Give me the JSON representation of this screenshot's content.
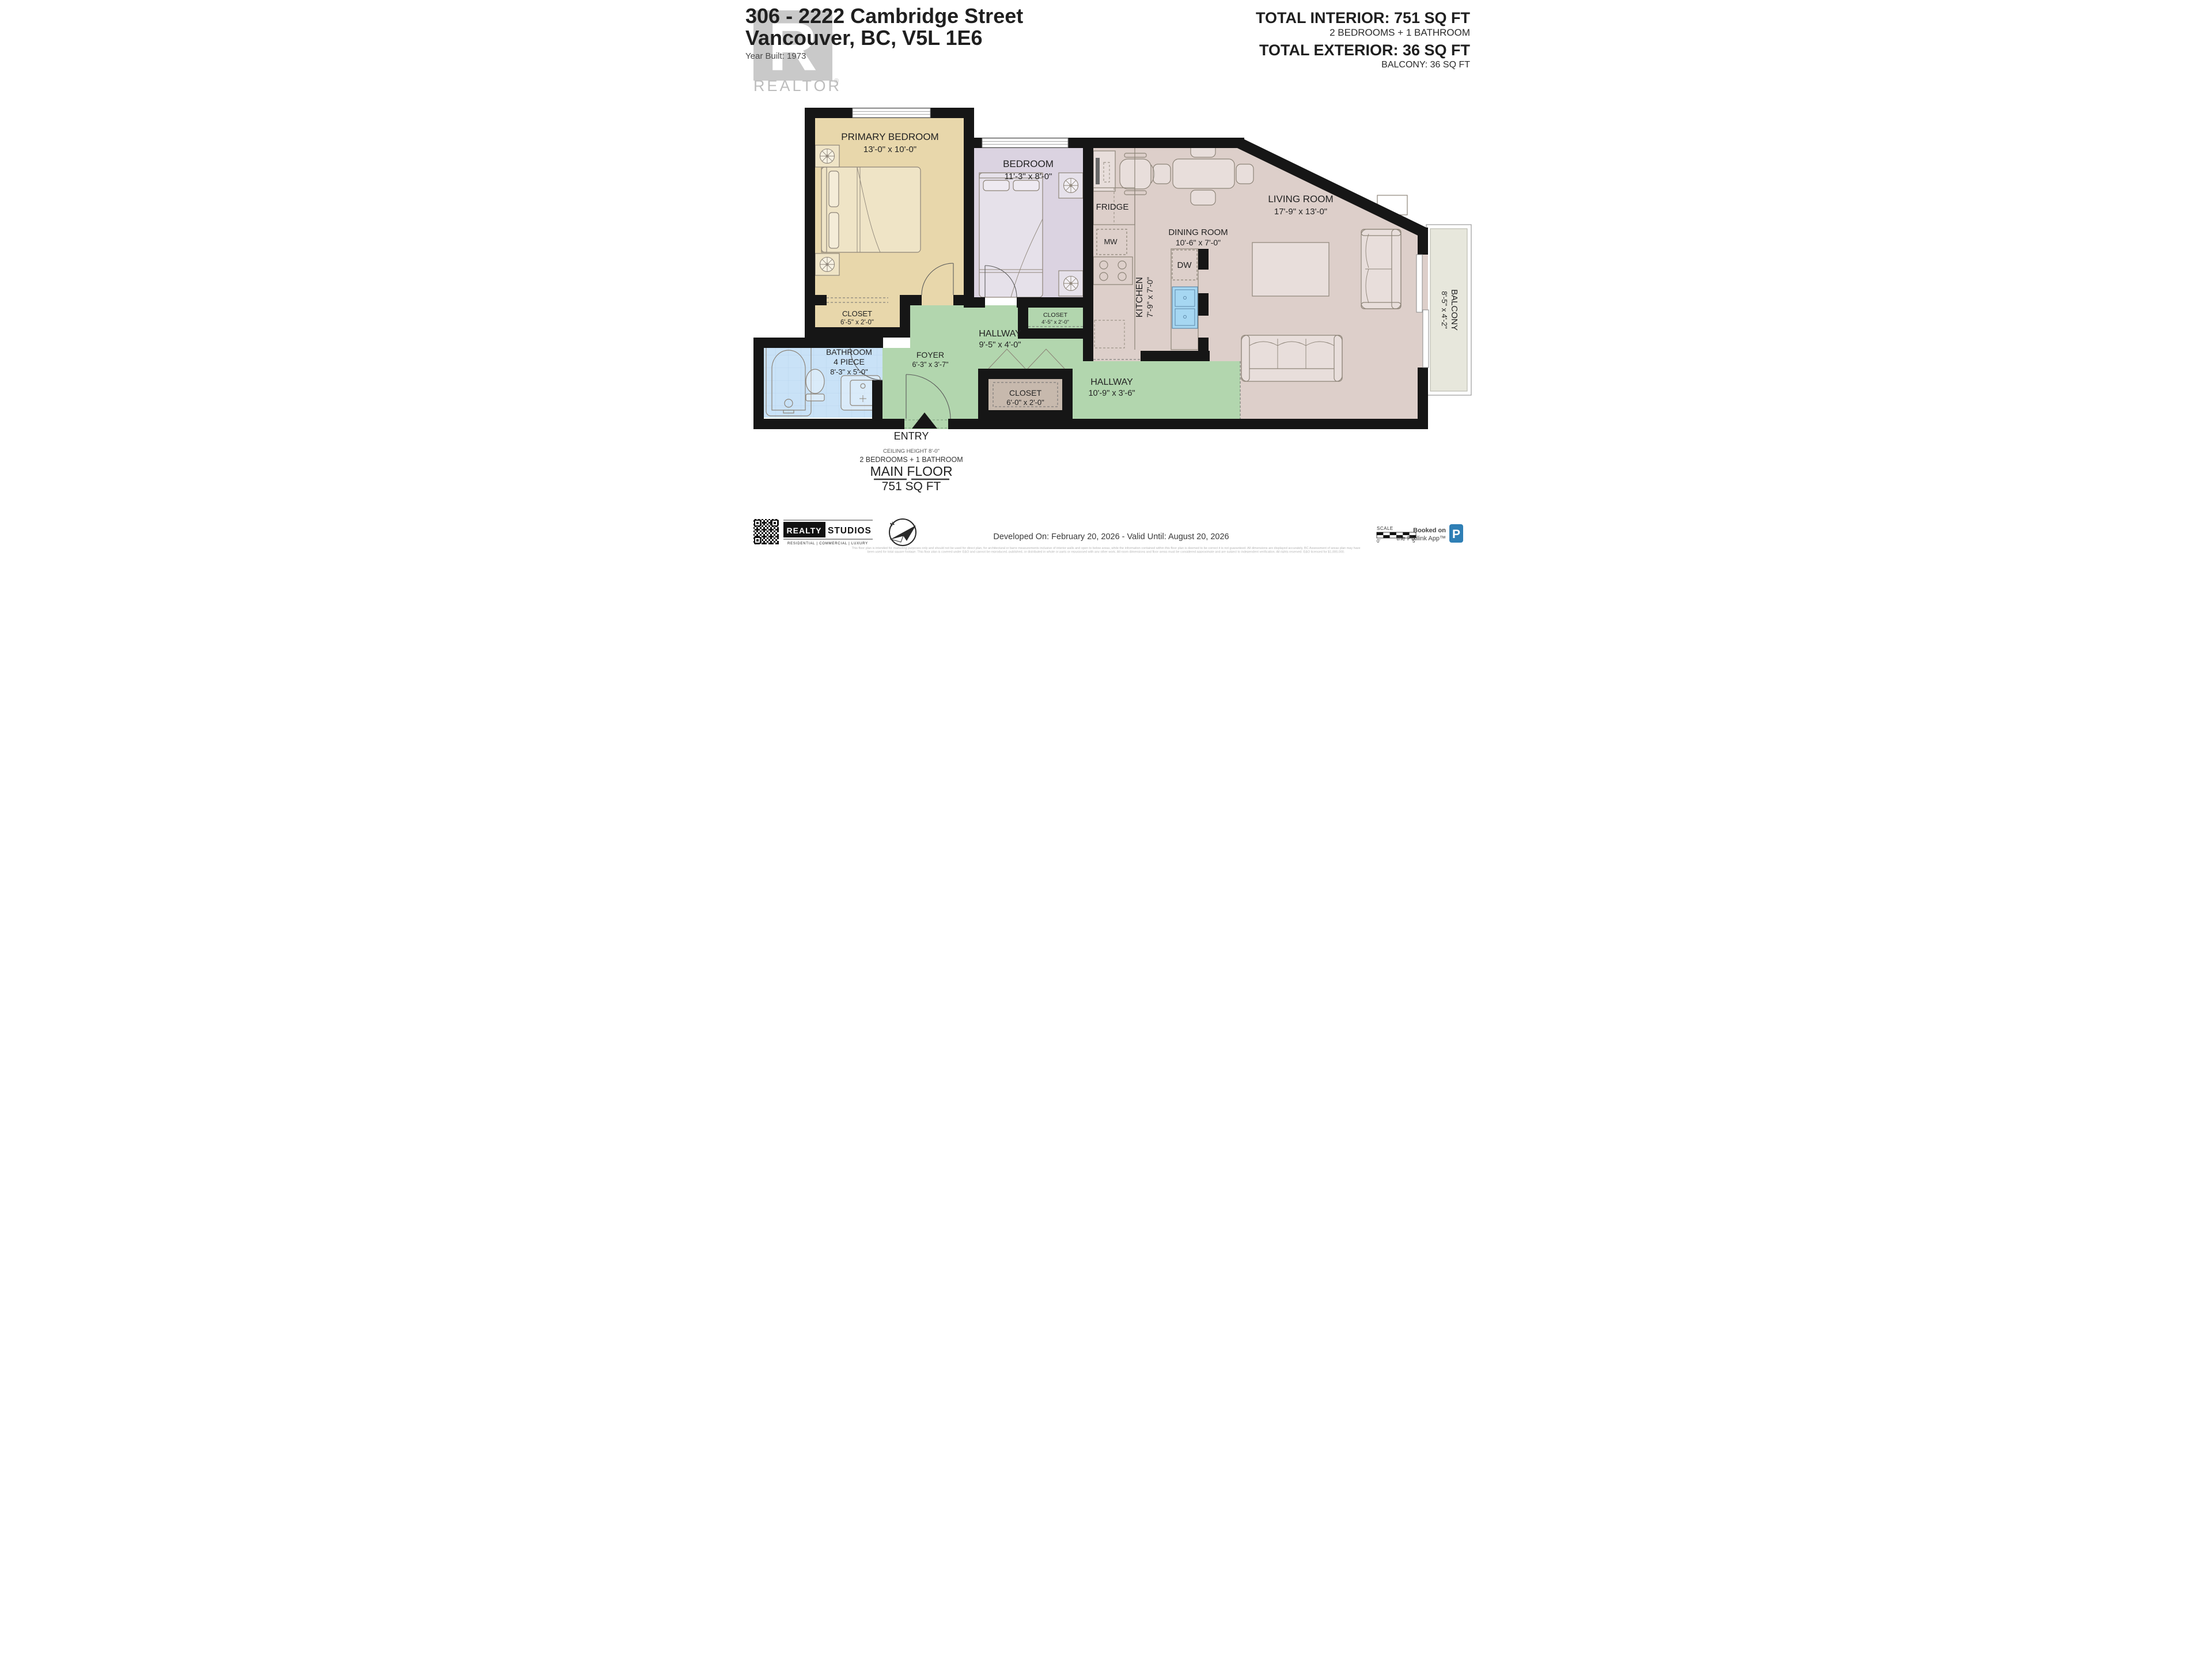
{
  "header": {
    "line1": "306 - 2222 Cambridge Street",
    "line2": "Vancouver, BC, V5L 1E6",
    "year_built": "Year Built: 1973"
  },
  "watermark": {
    "letter": "R",
    "brand": "REALTOR",
    "reg": "®"
  },
  "totals": {
    "interior_label": "TOTAL INTERIOR: 751 SQ FT",
    "interior_sub": "2 BEDROOMS + 1 BATHROOM",
    "exterior_label": "TOTAL EXTERIOR: 36 SQ FT",
    "exterior_sub": "BALCONY: 36 SQ FT"
  },
  "rooms": {
    "primary": {
      "name": "PRIMARY BEDROOM",
      "dims": "13'-0\" x 10'-0\""
    },
    "bedroom": {
      "name": "BEDROOM",
      "dims": "11'-3\" x 8'-0\""
    },
    "closet_primary": {
      "name": "CLOSET",
      "dims": "6'-5\" x 2'-0\""
    },
    "closet_bedroom": {
      "name": "CLOSET",
      "dims": "4'-5\" x 2'-0\""
    },
    "closet_hall": {
      "name": "CLOSET",
      "dims": "6'-0\" x 2'-0\""
    },
    "bathroom": {
      "name": "BATHROOM",
      "type": "4 PIECE",
      "dims": "8'-3\" x 5'-0\""
    },
    "foyer": {
      "name": "FOYER",
      "dims": "6'-3\" x 3'-7\""
    },
    "hallway_upper": {
      "name": "HALLWAY",
      "dims": "9'-5\" x 4'-0\""
    },
    "hallway_lower": {
      "name": "HALLWAY",
      "dims": "10'-9\" x 3'-6\""
    },
    "kitchen": {
      "name": "KITCHEN",
      "dims": "7'-9\" x 7'-0\""
    },
    "dining": {
      "name": "DINING ROOM",
      "dims": "10'-6\" x 7'-0\""
    },
    "living": {
      "name": "LIVING ROOM",
      "dims": "17'-9\" x 13'-0\""
    },
    "balcony": {
      "name": "BALCONY",
      "dims": "8'-5\" x 4'-2\""
    }
  },
  "appliances": {
    "fridge": "FRIDGE",
    "microwave": "MW",
    "dishwasher": "DW"
  },
  "entry": {
    "label": "ENTRY",
    "ceiling": "CEILING HEIGHT 8'-0\"",
    "config": "2 BEDROOMS + 1 BATHROOM",
    "floor_name": "MAIN FLOOR",
    "floor_area": "751 SQ FT"
  },
  "footer": {
    "developed": "Developed On: February 20, 2026 - Valid Until: August 20, 2026",
    "logo": {
      "realty": "REALTY",
      "studios": "STUDIOS",
      "tagline": "RESIDENTIAL | COMMERCIAL | LUXURY"
    },
    "compass_n": "N",
    "scale": {
      "label": "SCALE",
      "start": "0'",
      "end": "5'"
    },
    "booked_line1": "Booked on",
    "booked_line2": "the Pixilink App™",
    "app_letter": "P",
    "disclaimer_line1": "This floor plan is intended for marketing purposes only and should not be used for direct plan, for architectural or barre measurements inclusive of interior walls and open to below areas, while the information contained within this floor plan is deemed to be correct it is not guaranteed. All dimensions are displayed accurately, BC Assessment of areas plan may have",
    "disclaimer_line2": "been used for total square footage. This floor plan is covered under E&O and cannot be reproduced, published, or distributed in whole or parts or repurposed with any other work. All room dimensions and floor areas must be considered approximate and are subject to independent verification. All rights reserved. E&O licensed for $1,000,000."
  },
  "colors": {
    "tan": "#e8d7ab",
    "lavender": "#dbd3e1",
    "mauve": "#ddcfca",
    "green": "#b2d6ae",
    "blue": "#c9e2f7",
    "brown": "#c7b9ad",
    "balcony": "#e7e7dc",
    "wall": "#161616",
    "sink": "#a6d7f2",
    "accent_blue": "#2f7fb5"
  }
}
